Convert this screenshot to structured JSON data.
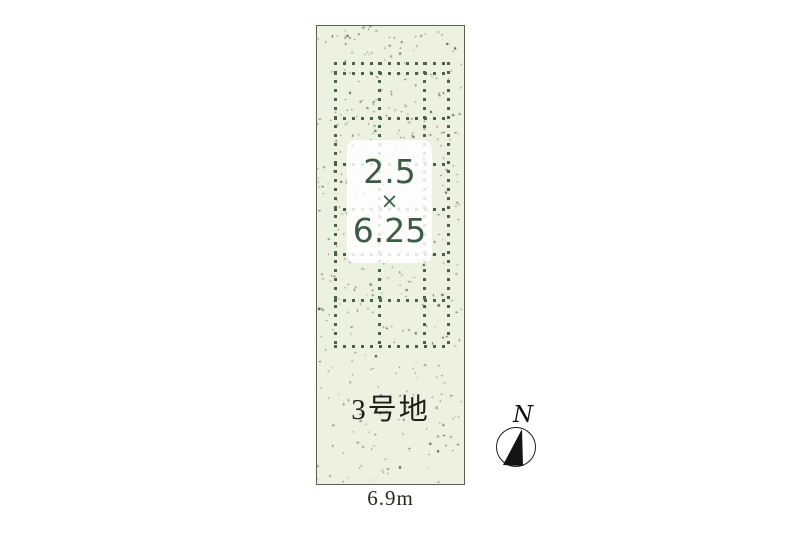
{
  "site_plan": {
    "plot_label": "3号地",
    "frontage_label": "6.9m",
    "stall_dimension": {
      "width": "2.5",
      "multiply_sign": "×",
      "depth": "6.25"
    },
    "colors": {
      "plot_fill": "#edf1e0",
      "plot_border": "#5e5e54",
      "grid_dot": "#4a614d",
      "dimension_text": "#3d5a46",
      "plot_text": "#1e1e1b"
    },
    "grid": {
      "v_lines_x": [
        334,
        378,
        423,
        447
      ],
      "h_lines_y": [
        62,
        72,
        117,
        163,
        208,
        253,
        299,
        345
      ],
      "x_range": [
        334,
        450
      ],
      "y_range": [
        62,
        348
      ],
      "dot_size": 3,
      "dot_pitch": 9
    }
  },
  "compass": {
    "north_label": "N"
  }
}
